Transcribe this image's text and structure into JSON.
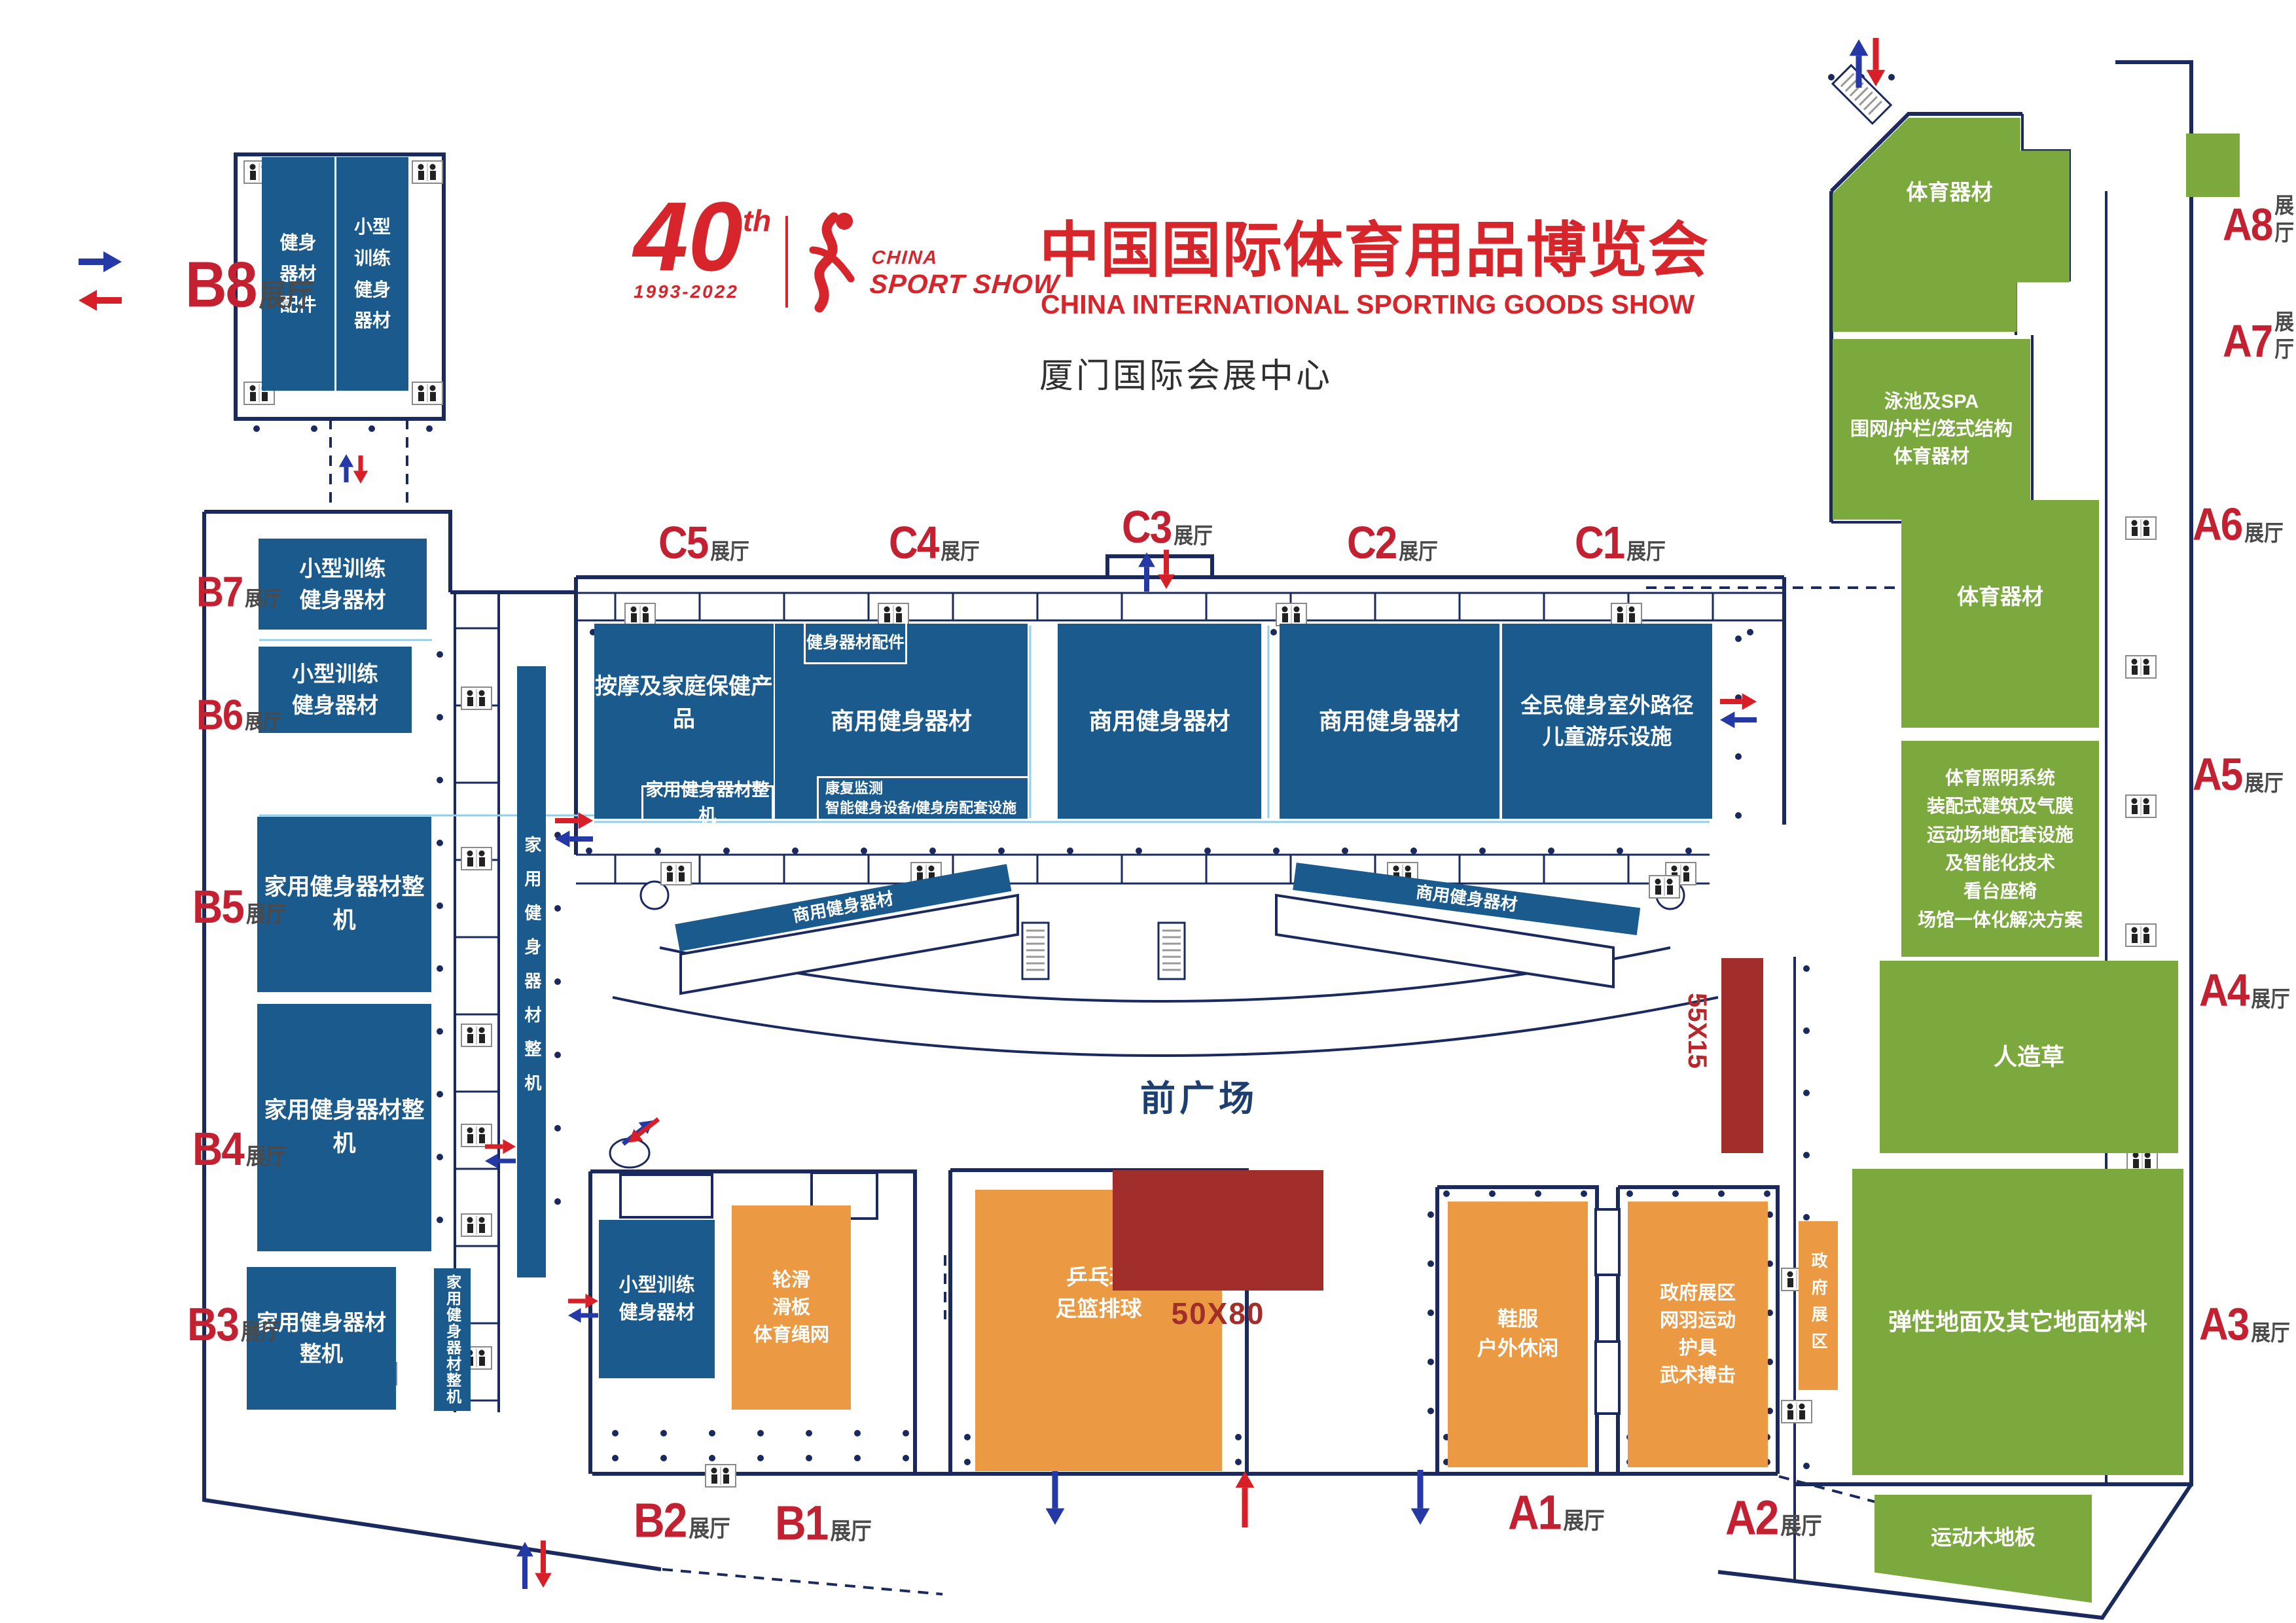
{
  "header": {
    "anniversary_number": "40",
    "anniversary_sup": "th",
    "anniversary_years": "1993-2022",
    "brand_line1": "CHINA",
    "brand_line2": "SPORT SHOW",
    "title_cn": "中国国际体育用品博览会",
    "title_en": "CHINA INTERNATIONAL SPORTING GOODS SHOW",
    "venue": "厦门国际会展中心"
  },
  "plaza_label": "前广场",
  "size_labels": {
    "plaza_booth": "50X80",
    "side_booth": "55X15"
  },
  "hall_suffix": "展厅",
  "halls": [
    {
      "code": "B8"
    },
    {
      "code": "B7"
    },
    {
      "code": "B6"
    },
    {
      "code": "B5"
    },
    {
      "code": "B4"
    },
    {
      "code": "B3"
    },
    {
      "code": "B2"
    },
    {
      "code": "B1"
    },
    {
      "code": "C5"
    },
    {
      "code": "C4"
    },
    {
      "code": "C3"
    },
    {
      "code": "C2"
    },
    {
      "code": "C1"
    },
    {
      "code": "A8"
    },
    {
      "code": "A7"
    },
    {
      "code": "A6"
    },
    {
      "code": "A5"
    },
    {
      "code": "A4"
    },
    {
      "code": "A3"
    },
    {
      "code": "A2"
    },
    {
      "code": "A1"
    }
  ],
  "zones": {
    "b8_left": "健身\n器材\n配件",
    "b8_right": "小型\n训练\n健身\n器材",
    "b7": "小型训练\n健身器材",
    "b6": "小型训练\n健身器材",
    "b5": "家用健身器材整机",
    "b4": "家用健身器材整机",
    "b3": "家用健身器材整机",
    "b_strip_long": "家用健身器材整机",
    "b_strip_short": "家用健身器材整机",
    "c5": "按摩及家庭保健产品",
    "c5_inner": "家用健身器材整机",
    "c4": "商用健身器材",
    "c4_top": "健身器材配件",
    "c4_bottom": "康复监测\n智能健身设备/健身房配套设施",
    "c3": "商用健身器材",
    "c2": "商用健身器材",
    "c1": "全民健身室外路径\n儿童游乐设施",
    "curve_left": "商用健身器材",
    "curve_right": "商用健身器材",
    "a8": "体育器材",
    "a7": "泳池及SPA\n围网/护栏/笼式结构\n体育器材",
    "a6": "体育器材",
    "a5": "体育照明系统\n装配式建筑及气膜\n运动场地配套设施\n及智能化技术\n看台座椅\n场馆一体化解决方案",
    "a4": "人造草",
    "a3": "弹性地面及其它地面材料",
    "wood_floor": "运动木地板",
    "b2_blue": "小型训练\n健身器材",
    "b2_orange": "轮滑\n滑板\n体育绳网",
    "b1_orange": "乒乓球\n足篮排球",
    "a1_orange": "鞋服\n户外休闲",
    "a2_orange": "政府展区\n网羽运动\n护具\n武术搏击",
    "gov_strip": "政府展区"
  },
  "colors": {
    "zone_blue": "#1a5a8c",
    "zone_green": "#7ca93d",
    "zone_orange": "#eb9a43",
    "booth_dark_red": "#a22e2b",
    "hall_label_red": "#c32031",
    "title_red": "#d6252b",
    "wall_navy": "#1b2a5e",
    "arrow_blue": "#2438a6",
    "arrow_red": "#d71f27"
  },
  "icons": {
    "toilet": "toilet-icon",
    "escalator": "escalator-icon",
    "entry_arrow": "entry-arrow-icon",
    "exit_arrow": "exit-arrow-icon"
  }
}
